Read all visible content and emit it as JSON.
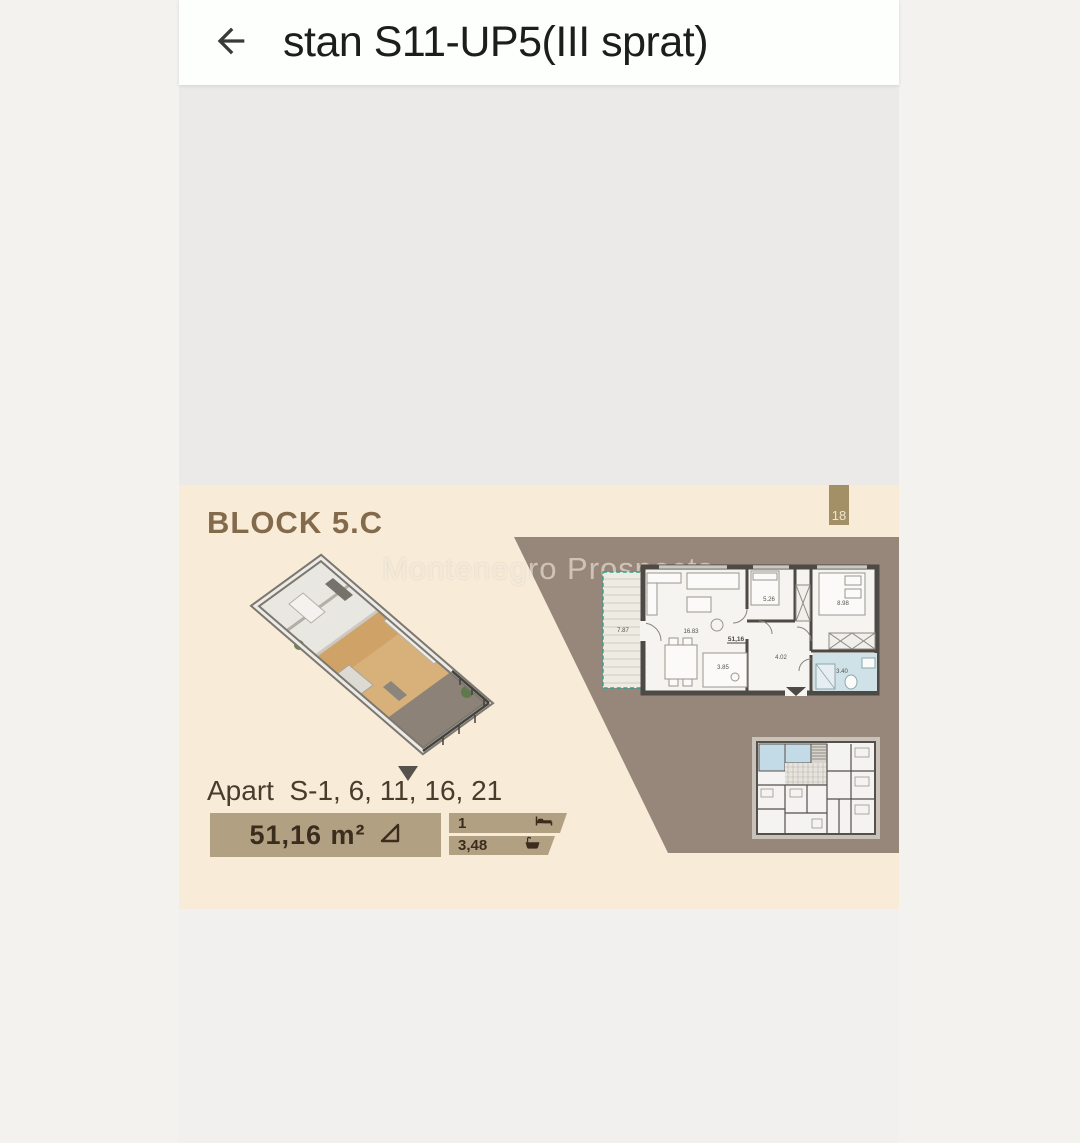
{
  "header": {
    "title": "stan S11-UP5(III sprat)",
    "back_icon": "arrow-left-icon"
  },
  "card": {
    "block_title": "BLOCK 5.C",
    "watermark": "Montenegro Prospects",
    "tab": "18",
    "apart_line": "Apart  S-1, 6, 11, 16, 21",
    "area_value": "51,16 m²",
    "area_icon": "set-square-triangle-icon",
    "stats": [
      {
        "value": "1",
        "icon": "bed-icon"
      },
      {
        "value": "3,48",
        "icon": "bathtub-icon"
      }
    ],
    "plan": {
      "terrace": "7.87",
      "living": "16.83",
      "total": "51,16",
      "bedroom_small": "5.26",
      "bedroom": "8.98",
      "hall": "4.02",
      "kitchen": "3.85",
      "bathroom": "3.40"
    }
  },
  "colors": {
    "page_bg": "#f3f2ef",
    "header_bg": "#fdfffd",
    "card_beige": "#f8ecd9",
    "brown_polygon": "#97867a",
    "tan_box": "#b2a083",
    "gold_tab": "#a39066",
    "block_title_brown": "#836a4b",
    "text_dark_brown": "#3b2d1e",
    "bathroom_blue": "#cfe2e7",
    "terrace_green": "#2ba18c"
  }
}
